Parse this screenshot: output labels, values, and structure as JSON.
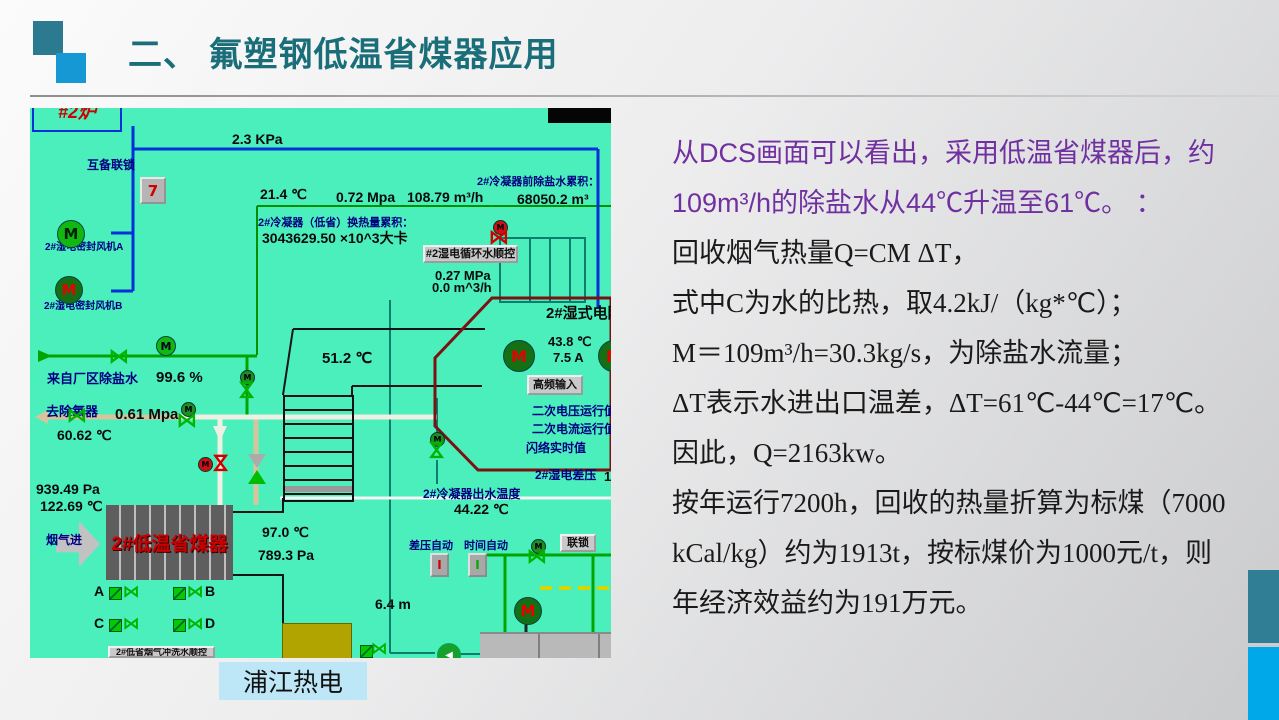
{
  "header": {
    "title": "二、 氟塑钢低温省煤器应用"
  },
  "caption": {
    "text": "浦江热电"
  },
  "narrative": {
    "lines": [
      {
        "text": "从DCS画面可以看出，采用低温省煤器后，约",
        "cls": "purple"
      },
      {
        "text": "109m³/h的除盐水从44℃升温至61℃。 ：",
        "cls": "purple"
      },
      {
        "text": "回收烟气热量Q=CM ΔT，",
        "cls": ""
      },
      {
        "text": "式中C为水的比热，取4.2kJ/（kg*℃）；",
        "cls": ""
      },
      {
        "text": "M＝109m³/h=30.3kg/s，为除盐水流量；",
        "cls": ""
      },
      {
        "text": "ΔT表示水进出口温差，ΔT=61℃-44℃=17℃。",
        "cls": ""
      },
      {
        "text": "因此，Q=2163kw。",
        "cls": ""
      },
      {
        "text": "按年运行7200h，回收的热量折算为标煤（7000",
        "cls": ""
      },
      {
        "text": "kCal/kg）约为1913t，按标煤价为1000元/t，则",
        "cls": ""
      },
      {
        "text": "年经济效益约为191万元。",
        "cls": ""
      }
    ]
  },
  "dcs": {
    "furnace_label": "#2炉",
    "economizer": {
      "text": "2#低温省煤器"
    },
    "labels": [
      {
        "text": "2.3 KPa",
        "x": 202,
        "y": 24,
        "cls": "b14"
      },
      {
        "text": "互备联锁",
        "x": 57,
        "y": 51,
        "cls": "navy12"
      },
      {
        "text": "2#湿电密封风机A",
        "x": 15,
        "y": 134,
        "cls": "navy10"
      },
      {
        "text": "2#湿电密封风机B",
        "x": 14,
        "y": 193,
        "cls": "navy10"
      },
      {
        "text": "21.4 ℃",
        "x": 230,
        "y": 79,
        "cls": "b14"
      },
      {
        "text": "0.72 Mpa",
        "x": 306,
        "y": 82,
        "cls": "b14"
      },
      {
        "text": "108.79 m³/h",
        "x": 377,
        "y": 82,
        "cls": "b14"
      },
      {
        "text": "2#冷凝器前除盐水累积：",
        "x": 447,
        "y": 68,
        "cls": "navy11"
      },
      {
        "text": "68050.2 m³",
        "x": 487,
        "y": 84,
        "cls": "b14"
      },
      {
        "text": "2#冷凝器（低省）换热量累积：",
        "x": 228,
        "y": 109,
        "cls": "navy11"
      },
      {
        "text": "3043629.50 ×10^3大卡",
        "x": 232,
        "y": 123,
        "cls": "b14"
      },
      {
        "text": "0.27 MPa",
        "x": 405,
        "y": 161,
        "cls": "b13"
      },
      {
        "text": "0.0 m^3/h",
        "x": 402,
        "y": 173,
        "cls": "b13"
      },
      {
        "text": "2#湿式电除尘",
        "x": 516,
        "y": 198,
        "cls": "b15"
      },
      {
        "text": "43.8 ℃",
        "x": 518,
        "y": 227,
        "cls": "b13"
      },
      {
        "text": "7.5 A",
        "x": 523,
        "y": 243,
        "cls": "b13"
      },
      {
        "text": "二次电压运行值",
        "x": 502,
        "y": 297,
        "cls": "navy12"
      },
      {
        "text": "二次电流运行值",
        "x": 502,
        "y": 315,
        "cls": "navy12"
      },
      {
        "text": "闪络实时值",
        "x": 496,
        "y": 334,
        "cls": "navy12"
      },
      {
        "text": "2#湿电差压",
        "x": 505,
        "y": 361,
        "cls": "navy12"
      },
      {
        "text": "1",
        "x": 574,
        "y": 362,
        "cls": "b13"
      },
      {
        "text": "51.2 ℃",
        "x": 292,
        "y": 243,
        "cls": "b15"
      },
      {
        "text": "来自厂区除盐水",
        "x": 17,
        "y": 264,
        "cls": "navy13"
      },
      {
        "text": "99.6 %",
        "x": 126,
        "y": 262,
        "cls": "b15"
      },
      {
        "text": "去除氧器",
        "x": 16,
        "y": 297,
        "cls": "navy13"
      },
      {
        "text": "0.61 Mpa",
        "x": 85,
        "y": 299,
        "cls": "b15"
      },
      {
        "text": "60.62 ℃",
        "x": 27,
        "y": 320,
        "cls": "b14"
      },
      {
        "text": "939.49 Pa",
        "x": 6,
        "y": 374,
        "cls": "b14"
      },
      {
        "text": "122.69 ℃",
        "x": 10,
        "y": 391,
        "cls": "b14"
      },
      {
        "text": "烟气进",
        "x": 16,
        "y": 426,
        "cls": "navy12"
      },
      {
        "text": "97.0 ℃",
        "x": 232,
        "y": 417,
        "cls": "b14"
      },
      {
        "text": "789.3 Pa",
        "x": 228,
        "y": 440,
        "cls": "b14"
      },
      {
        "text": "2#冷凝器出水温度",
        "x": 393,
        "y": 380,
        "cls": "navy12"
      },
      {
        "text": "44.22 ℃",
        "x": 424,
        "y": 394,
        "cls": "b14"
      },
      {
        "text": "差压自动",
        "x": 379,
        "y": 432,
        "cls": "navy11"
      },
      {
        "text": "时间自动",
        "x": 434,
        "y": 432,
        "cls": "navy11"
      },
      {
        "text": "6.4 m",
        "x": 345,
        "y": 489,
        "cls": "b14"
      },
      {
        "text": "A",
        "x": 64,
        "y": 476,
        "cls": "b14"
      },
      {
        "text": "B",
        "x": 175,
        "y": 476,
        "cls": "b14"
      },
      {
        "text": "C",
        "x": 64,
        "y": 508,
        "cls": "b14"
      },
      {
        "text": "D",
        "x": 175,
        "y": 508,
        "cls": "b14"
      }
    ],
    "buttons": [
      {
        "text": "#2湿电循环水顺控",
        "x": 393,
        "y": 137,
        "w": 95,
        "h": 18
      },
      {
        "text": "高频输入",
        "x": 497,
        "y": 267,
        "w": 56,
        "h": 20
      },
      {
        "text": "联锁",
        "x": 530,
        "y": 426,
        "w": 36,
        "h": 18
      },
      {
        "text": "2#低省烟气冲洗水顺控",
        "x": 78,
        "y": 538,
        "w": 107,
        "h": 12,
        "cls": "tiny"
      }
    ],
    "icons": [
      {
        "cls": "ic-interlock",
        "g": "7",
        "x": 110,
        "y": 69
      },
      {
        "cls": "ic-motor bright",
        "g": "M",
        "x": 27,
        "y": 112
      },
      {
        "cls": "ic-motor dark",
        "g": "M",
        "x": 25,
        "y": 168
      },
      {
        "cls": "ic-msmall",
        "g": "M",
        "x": 126,
        "y": 228
      },
      {
        "cls": "ic-valve",
        "g": "⋈",
        "x": 78,
        "y": 240
      },
      {
        "cls": "ic-mtiny",
        "g": "M",
        "x": 210,
        "y": 262
      },
      {
        "cls": "ic-valve vert",
        "g": "⋈",
        "x": 206,
        "y": 274
      },
      {
        "cls": "ic-valve",
        "g": "⋈",
        "x": 36,
        "y": 299
      },
      {
        "cls": "ic-mtiny",
        "g": "M",
        "x": 151,
        "y": 294
      },
      {
        "cls": "ic-valve",
        "g": "⋈",
        "x": 146,
        "y": 304
      },
      {
        "cls": "ic-mtiny red",
        "g": "M",
        "x": 168,
        "y": 349
      },
      {
        "cls": "ic-valve vert red",
        "g": "⋈",
        "x": 180,
        "y": 347
      },
      {
        "cls": "ic-vgg",
        "g": "",
        "x": 218,
        "y": 346
      },
      {
        "cls": "ic-mtiny red",
        "g": "M",
        "x": 463,
        "y": 112
      },
      {
        "cls": "ic-valve red",
        "g": "⋈",
        "x": 458,
        "y": 121
      },
      {
        "cls": "ic-motor dark esp",
        "g": "M",
        "x": 473,
        "y": 232
      },
      {
        "cls": "ic-motor dark esp",
        "g": "M",
        "x": 568,
        "y": 232
      },
      {
        "cls": "ic-mtiny",
        "g": "M",
        "x": 400,
        "y": 324
      },
      {
        "cls": "ic-valve vert",
        "g": "⋈",
        "x": 396,
        "y": 334
      },
      {
        "cls": "ic-auto red",
        "g": "I",
        "x": 400,
        "y": 445
      },
      {
        "cls": "ic-auto green",
        "g": "I",
        "x": 438,
        "y": 445
      },
      {
        "cls": "ic-mtiny",
        "g": "M",
        "x": 501,
        "y": 431
      },
      {
        "cls": "ic-valve",
        "g": "⋈",
        "x": 496,
        "y": 440
      },
      {
        "cls": "ic-motor dark",
        "g": "M",
        "x": 484,
        "y": 489
      },
      {
        "cls": "ic-pump",
        "g": "◀",
        "x": 407,
        "y": 535
      },
      {
        "cls": "ic-sq",
        "g": "",
        "x": 79,
        "y": 479
      },
      {
        "cls": "ic-valve small",
        "g": "⋈",
        "x": 90,
        "y": 476
      },
      {
        "cls": "ic-sq",
        "g": "",
        "x": 143,
        "y": 479
      },
      {
        "cls": "ic-valve small",
        "g": "⋈",
        "x": 154,
        "y": 476
      },
      {
        "cls": "ic-sq",
        "g": "",
        "x": 79,
        "y": 511
      },
      {
        "cls": "ic-valve small",
        "g": "⋈",
        "x": 90,
        "y": 508
      },
      {
        "cls": "ic-sq",
        "g": "",
        "x": 143,
        "y": 511
      },
      {
        "cls": "ic-valve small",
        "g": "⋈",
        "x": 154,
        "y": 508
      },
      {
        "cls": "ic-sq",
        "g": "",
        "x": 330,
        "y": 537
      },
      {
        "cls": "ic-valve small",
        "g": "⋈",
        "x": 338,
        "y": 533
      }
    ]
  },
  "colors": {
    "accent_teal": "#1A6E79",
    "accent_blue": "#1598D4",
    "purple": "#7030A0",
    "dcs_background": "#4BEFBC",
    "edge_teal": "#2F7E96",
    "edge_blue": "#00A7E9"
  }
}
